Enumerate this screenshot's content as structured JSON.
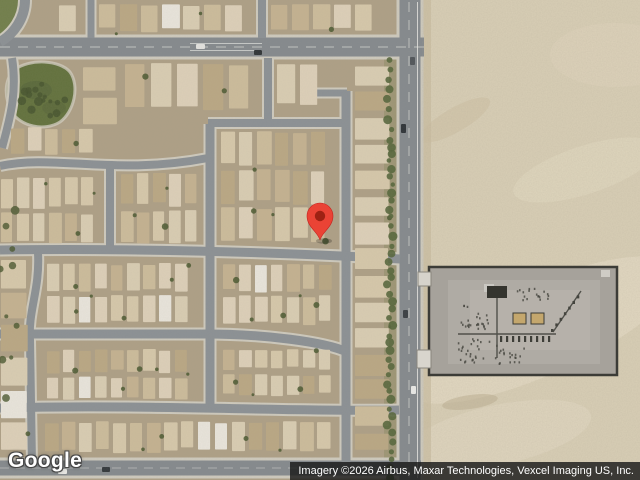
{
  "branding": {
    "logo_text": "Google"
  },
  "attribution": {
    "text": "Imagery ©2026 Airbus, Maxar Technologies, Vexcel Imaging US, Inc."
  },
  "marker": {
    "kind": "dropped-pin",
    "transform": "translate(320,240)",
    "body_color": "#EA4335",
    "dot_color": "#9E2113"
  },
  "palette": {
    "desert": "#d9cfb6",
    "desert_wash": "#eae0ca",
    "residential_ground": "#ad9f86",
    "asphalt": "#8b9094",
    "asphalt_major": "#84898d",
    "sidewalk": "#cdc9bd",
    "vegetation": "#57663c",
    "tree": "#4a5830",
    "park": "#62713d",
    "roof_white": "#e8e4db",
    "roof_shades": [
      "#d5c7aa",
      "#cbbb9b",
      "#dccfb8",
      "#c3b190",
      "#d8ccb2",
      "#b9a784"
    ],
    "substation_pad": "#a6a29b",
    "substation_fence": "#3c3c37",
    "transformer_tan": "#c4a76d"
  }
}
